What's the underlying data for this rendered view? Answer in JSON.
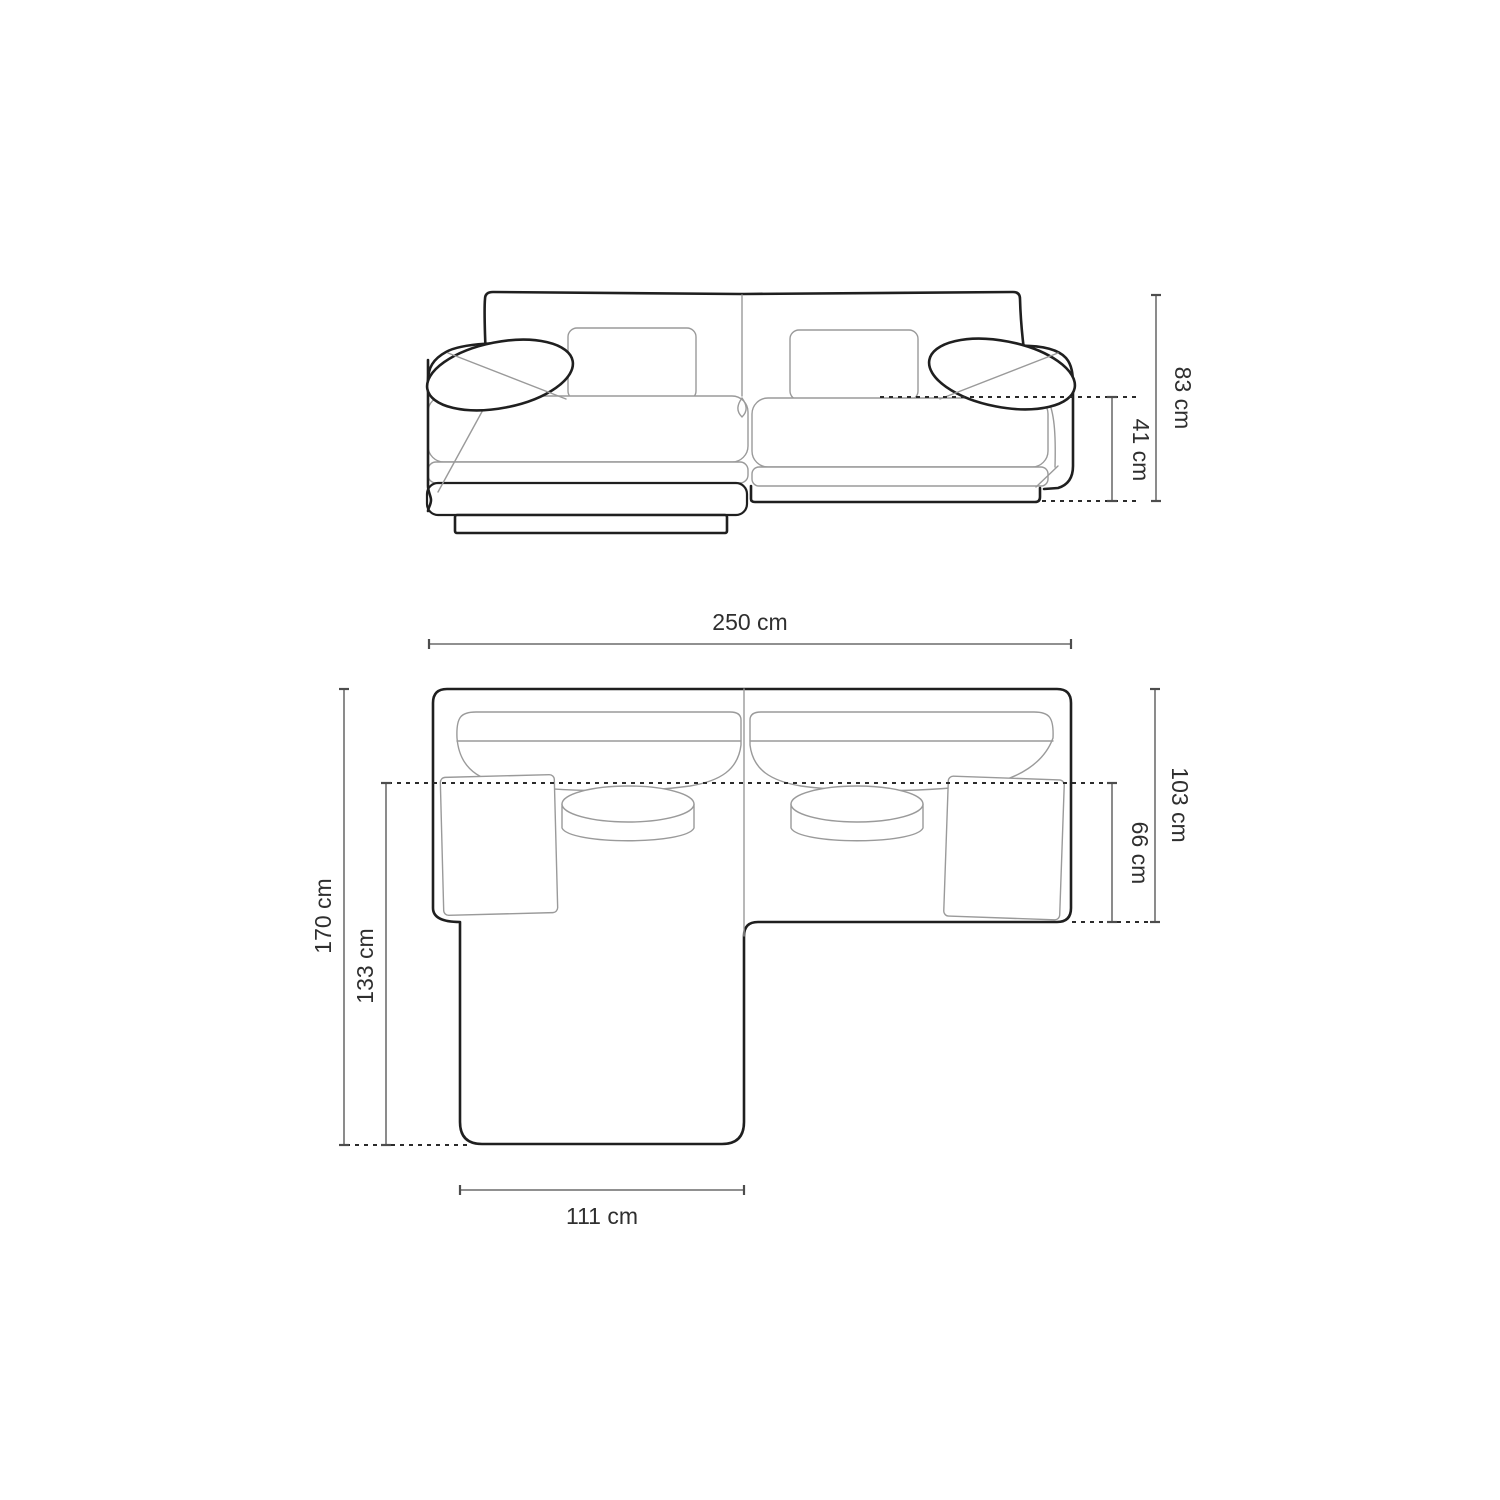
{
  "diagram": {
    "type": "sofa-dimension-drawing",
    "background": "#ffffff",
    "colors": {
      "outline": "#1f1f1f",
      "detail_line": "#9a9a9a",
      "dimension_line": "#4d4d4d",
      "dashed_line": "#2b2b2b",
      "label_text": "#2f2f2f"
    },
    "dimensions": {
      "front_view": {
        "overall_height": "83 cm",
        "seat_height": "41 cm"
      },
      "top_view": {
        "overall_width": "250 cm",
        "overall_depth": "170 cm",
        "chaise_depth": "133 cm",
        "body_depth": "103 cm",
        "seat_depth": "66 cm",
        "chaise_width": "111 cm"
      }
    }
  }
}
